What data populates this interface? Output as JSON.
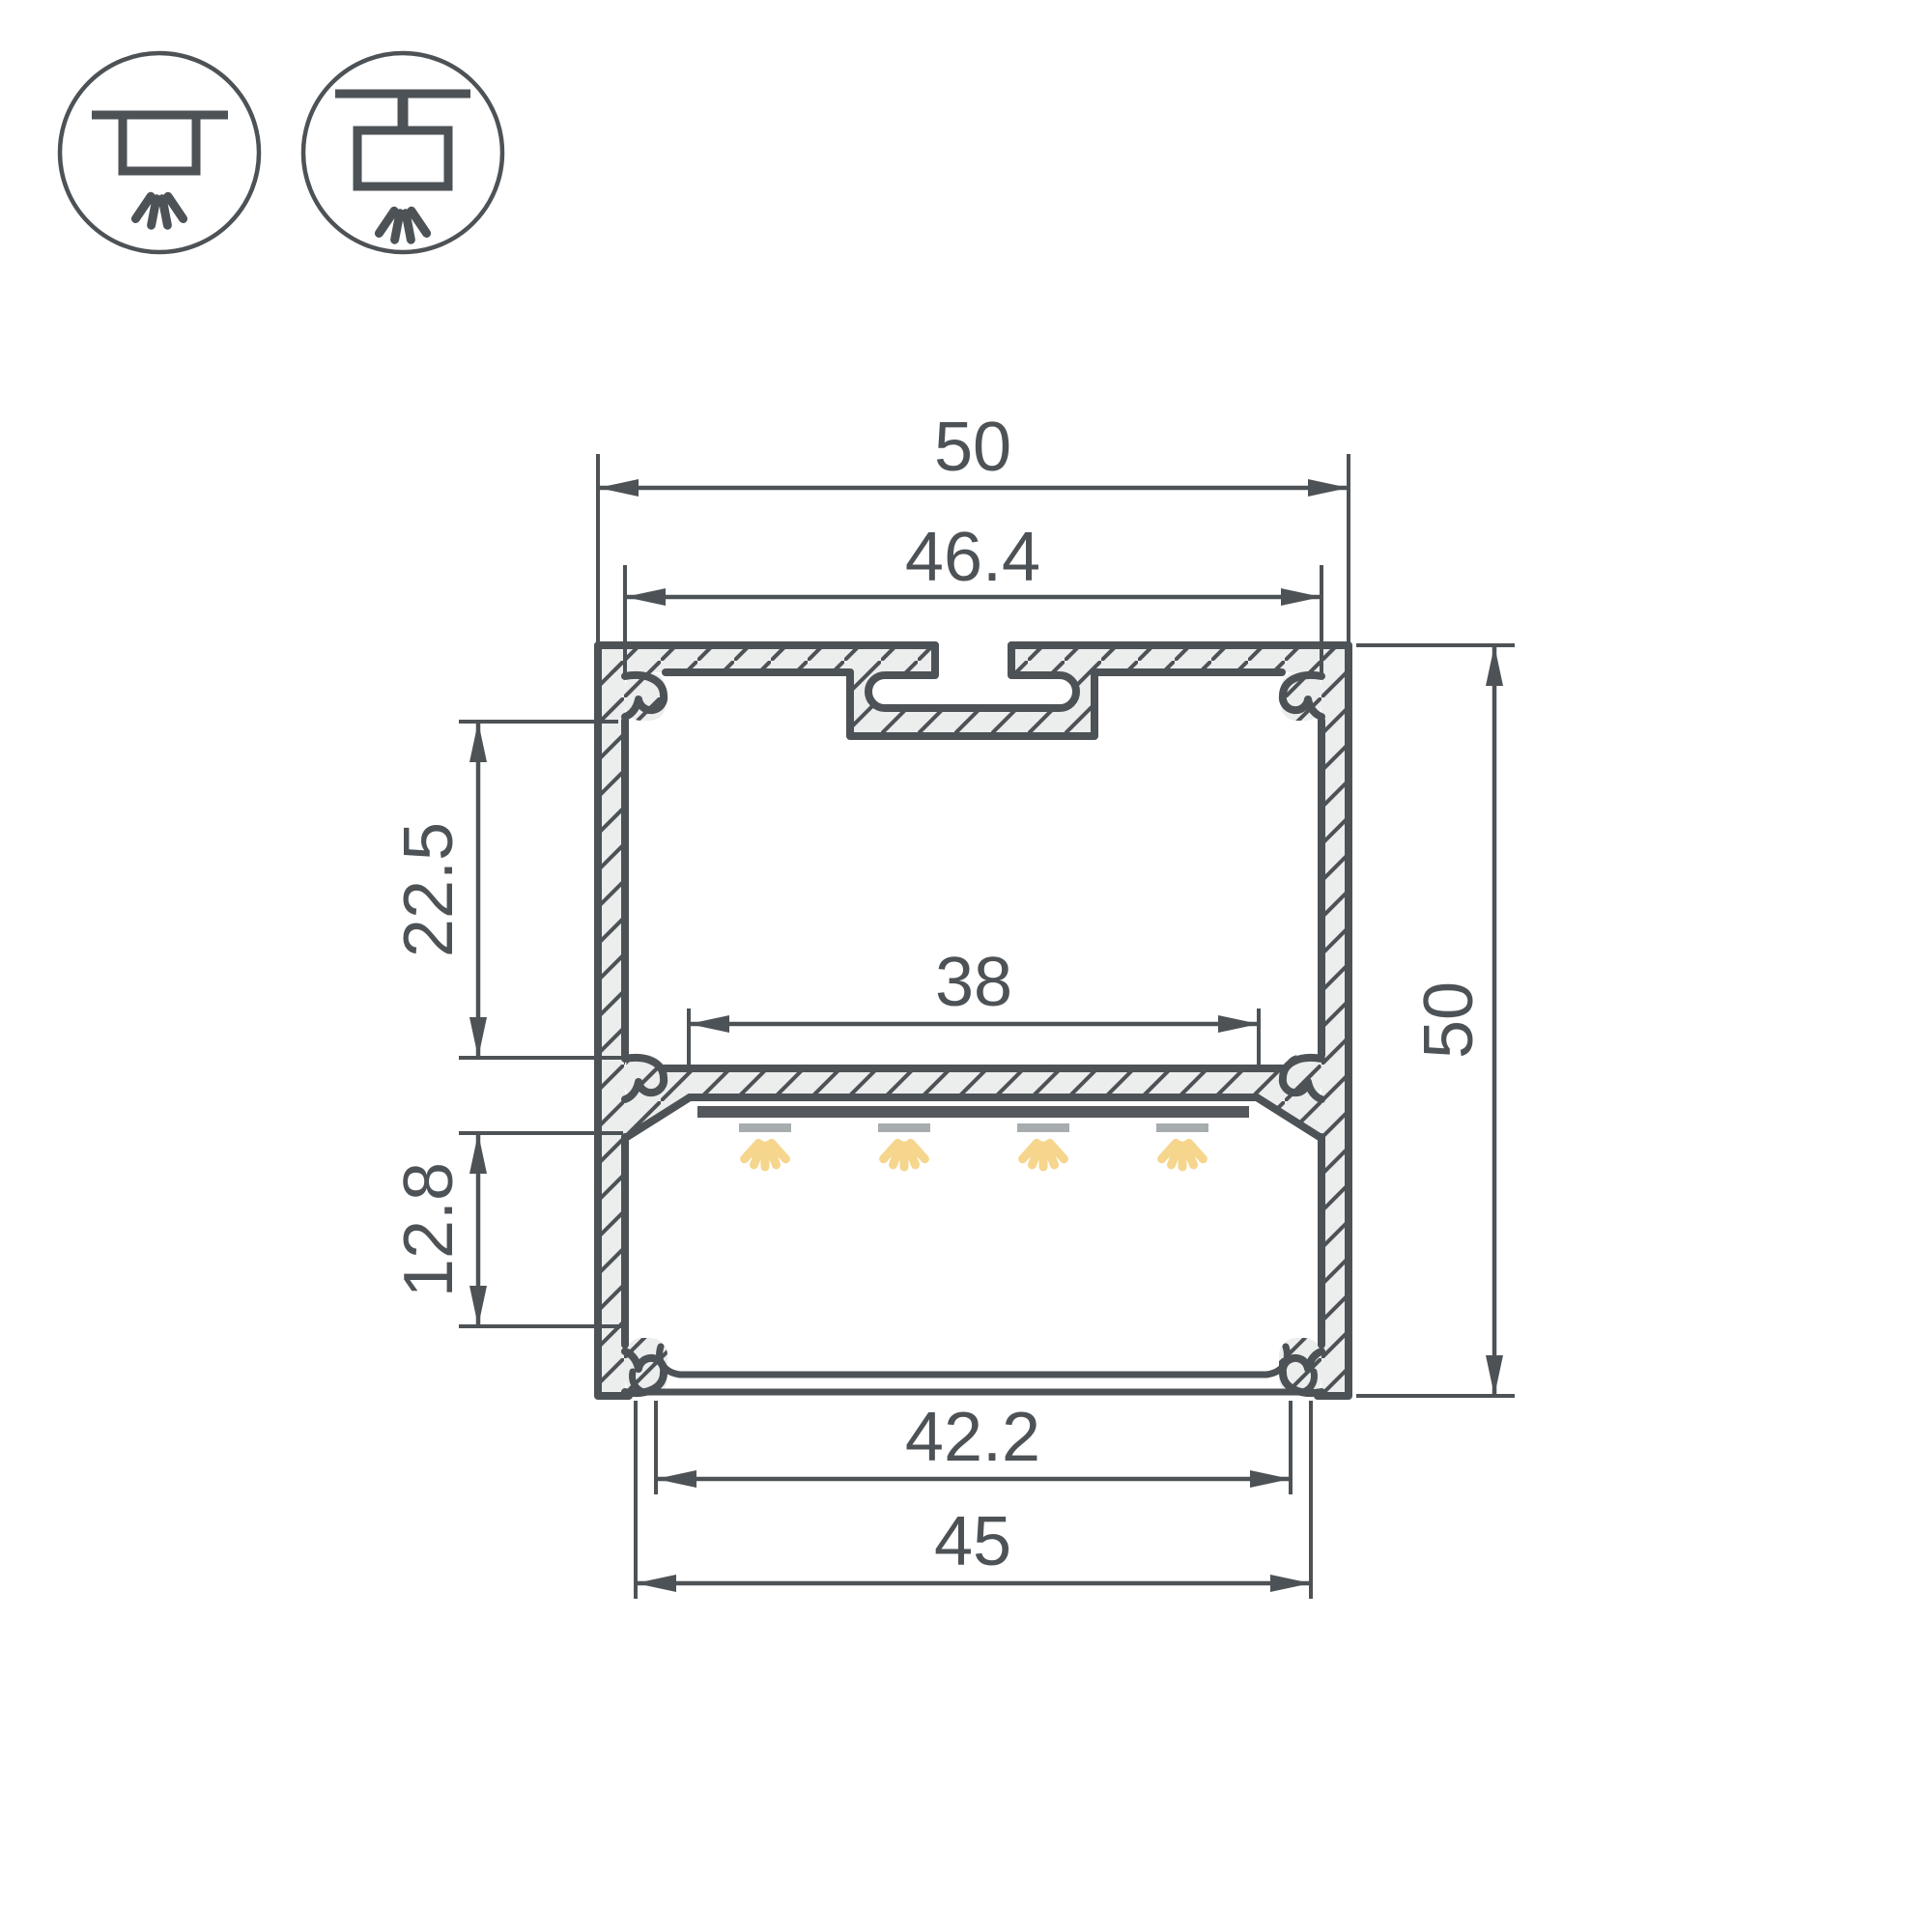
{
  "drawing": {
    "type": "technical-cross-section",
    "subject": "LED aluminium profile cross-section with LED strip and diffuser",
    "background": "#ffffff"
  },
  "colors": {
    "line": "#4d5256",
    "metal_fill": "#eceded",
    "led_bar": "#54585c",
    "led_module": "#a7acaf",
    "light_ray": "#f6d58d"
  },
  "icons": [
    {
      "name": "surface-mount-luminaire-icon",
      "description": "ceiling line with box fixture and light rays"
    },
    {
      "name": "suspended-luminaire-icon",
      "description": "ceiling line with stem, box fixture and light rays"
    }
  ],
  "dimensions": {
    "overall_width": {
      "label": "50",
      "value_mm": 50,
      "orientation": "horizontal"
    },
    "top_inner_width": {
      "label": "46.4",
      "value_mm": 46.4,
      "orientation": "horizontal"
    },
    "upper_chamber_height": {
      "label": "22.5",
      "value_mm": 22.5,
      "orientation": "vertical"
    },
    "led_platform_width": {
      "label": "38",
      "value_mm": 38,
      "orientation": "horizontal"
    },
    "lower_chamber_height": {
      "label": "12.8",
      "value_mm": 12.8,
      "orientation": "vertical"
    },
    "cover_inner_width": {
      "label": "42.2",
      "value_mm": 42.2,
      "orientation": "horizontal"
    },
    "cover_outer_width": {
      "label": "45",
      "value_mm": 45,
      "orientation": "horizontal"
    },
    "overall_height": {
      "label": "50",
      "value_mm": 50,
      "orientation": "vertical"
    }
  }
}
